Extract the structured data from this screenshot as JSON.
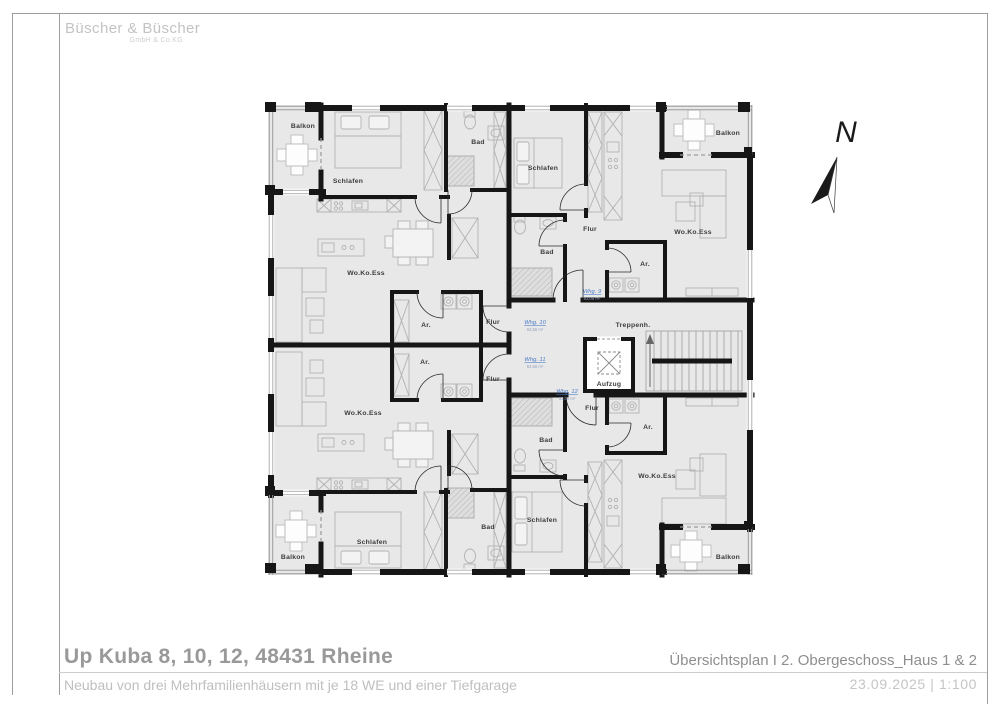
{
  "logo": {
    "name": "Büscher & Büscher",
    "suffix": "GmbH & Co.KG"
  },
  "titleblock": {
    "project_title": "Up Kuba 8, 10, 12, 48431 Rheine",
    "project_subtitle": "Neubau von drei Mehrfamilienhäusern mit je 18 WE und einer Tiefgarage",
    "plan_title": "Übersichtsplan I 2. Obergeschoss_Haus 1 & 2",
    "plan_date_scale": "23.09.2025 | 1:100"
  },
  "north_label": "N",
  "plan": {
    "floor_name": "2. Obergeschoss",
    "room_labels": [
      {
        "t": "Balkon",
        "x": 303,
        "y": 128
      },
      {
        "t": "Schlafen",
        "x": 348,
        "y": 183
      },
      {
        "t": "Bad",
        "x": 478,
        "y": 144
      },
      {
        "t": "Wo.Ko.Ess",
        "x": 366,
        "y": 275
      },
      {
        "t": "Ar.",
        "x": 426,
        "y": 327
      },
      {
        "t": "Flur",
        "x": 493,
        "y": 324
      },
      {
        "t": "Schlafen",
        "x": 543,
        "y": 170
      },
      {
        "t": "Balkon",
        "x": 728,
        "y": 135
      },
      {
        "t": "Wo.Ko.Ess",
        "x": 693,
        "y": 234
      },
      {
        "t": "Flur",
        "x": 590,
        "y": 231
      },
      {
        "t": "Bad",
        "x": 547,
        "y": 254
      },
      {
        "t": "Ar.",
        "x": 645,
        "y": 266
      },
      {
        "t": "Treppenh.",
        "x": 633,
        "y": 327
      },
      {
        "t": "Aufzug",
        "x": 609,
        "y": 386
      },
      {
        "t": "Flur",
        "x": 493,
        "y": 381
      },
      {
        "t": "Ar.",
        "x": 425,
        "y": 364
      },
      {
        "t": "Wo.Ko.Ess",
        "x": 363,
        "y": 415
      },
      {
        "t": "Schlafen",
        "x": 372,
        "y": 544
      },
      {
        "t": "Bad",
        "x": 488,
        "y": 529
      },
      {
        "t": "Balkon",
        "x": 293,
        "y": 559
      },
      {
        "t": "Flur",
        "x": 592,
        "y": 410
      },
      {
        "t": "Ar.",
        "x": 648,
        "y": 429
      },
      {
        "t": "Bad",
        "x": 546,
        "y": 442
      },
      {
        "t": "Wo.Ko.Ess",
        "x": 657,
        "y": 478
      },
      {
        "t": "Schlafen",
        "x": 542,
        "y": 522
      },
      {
        "t": "Balkon",
        "x": 728,
        "y": 559
      }
    ],
    "apartments": [
      {
        "name": "Whg. 9",
        "area": "93,08 m²",
        "x": 592,
        "y": 293
      },
      {
        "name": "Whg. 10",
        "area": "84,56 m²",
        "x": 535,
        "y": 324
      },
      {
        "name": "Whg. 11",
        "area": "84,56 m²",
        "x": 535,
        "y": 361
      },
      {
        "name": "Whg. 12",
        "area": "93,08 m²",
        "x": 567,
        "y": 393
      }
    ],
    "colors": {
      "floor_fill": "#e8e8e8",
      "wall": "#161616",
      "furniture": "#b2b2b2",
      "room_label": "#3c3c3c",
      "apartment_label": "#4a7bc8",
      "apartment_area": "#93a2bd"
    }
  }
}
